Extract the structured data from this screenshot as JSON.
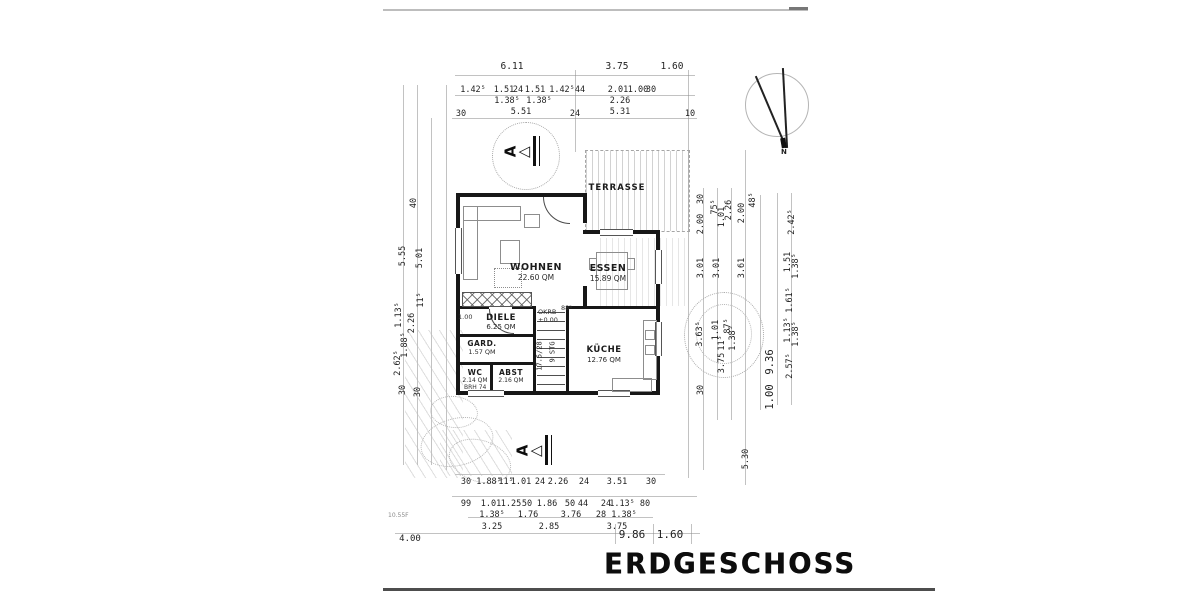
{
  "title": "ERDGESCHOSS",
  "colors": {
    "ink": "#1c1c1c",
    "paper": "#ffffff"
  },
  "compass": {
    "label": "N"
  },
  "section_marker": {
    "label": "A"
  },
  "rooms": {
    "terrasse": {
      "name": "TERRASSE"
    },
    "wohnen": {
      "name": "WOHNEN",
      "area": "22.60 QM"
    },
    "essen": {
      "name": "ESSEN",
      "area": "15.89 QM"
    },
    "diele": {
      "name": "DIELE",
      "area": "6.25 QM"
    },
    "kueche": {
      "name": "KÜCHE",
      "area": "12.76 QM"
    },
    "gard": {
      "name": "GARD.",
      "area": "1.57 QM"
    },
    "wc": {
      "name": "WC",
      "area": "2.14 QM",
      "note": "BRH 74"
    },
    "abst": {
      "name": "ABST",
      "area": "2.16 QM"
    }
  },
  "annotations": {
    "level_label": "OKRB",
    "level_value": "±0.00",
    "stair_count": "9 STG",
    "stair_ratio": "17.5/28",
    "door_width": "88⁵",
    "wall_dim": "1.00",
    "faint_note": "10.55F"
  },
  "dims": {
    "top_total": [
      "6.11",
      "3.75",
      "1.60"
    ],
    "top_chain": [
      "1.42⁵",
      "1.51",
      "24",
      "1.51",
      "1.42⁵",
      "44",
      "2.01",
      "1.00",
      "30"
    ],
    "top_sub": [
      "1.38⁵",
      "1.38⁵",
      "2.26"
    ],
    "top_low": [
      "30",
      "5.51",
      "24",
      "5.31",
      "10"
    ],
    "bottom_r1": [
      "30",
      "1.88⁵",
      "11⁵",
      "1.01",
      "24",
      "2.26",
      "24",
      "3.51",
      "30"
    ],
    "bottom_r2": [
      "99",
      "1.01",
      "1.25",
      "50",
      "1.86",
      "50",
      "44",
      "24",
      "1.13⁵",
      "80"
    ],
    "bottom_r3": [
      "1.38⁵",
      "1.76",
      "3.76",
      "28",
      "1.38⁵"
    ],
    "bottom_r4": [
      "3.25",
      "2.85",
      "3.75"
    ],
    "bottom_total": [
      "4.00",
      "9.86",
      "1.60"
    ],
    "left": [
      "40",
      "5.55",
      "5.01",
      "11⁵",
      "1.13⁵",
      "2.26",
      "1.88⁵",
      "2.62⁵",
      "30",
      "30"
    ],
    "right": [
      "30",
      "75⁵",
      "1.01",
      "2.26",
      "2.00",
      "48⁵",
      "2.00",
      "3.01",
      "3.01",
      "3.61",
      "3.63⁵",
      "1.01",
      "87⁵",
      "11⁵",
      "1.38⁵",
      "3.75",
      "30",
      "9.36",
      "1.00",
      "5.30",
      "2.42⁵",
      "1.51",
      "1.38⁵",
      "1.61⁵",
      "1.13⁵",
      "1.38⁵",
      "2.57⁵"
    ]
  }
}
